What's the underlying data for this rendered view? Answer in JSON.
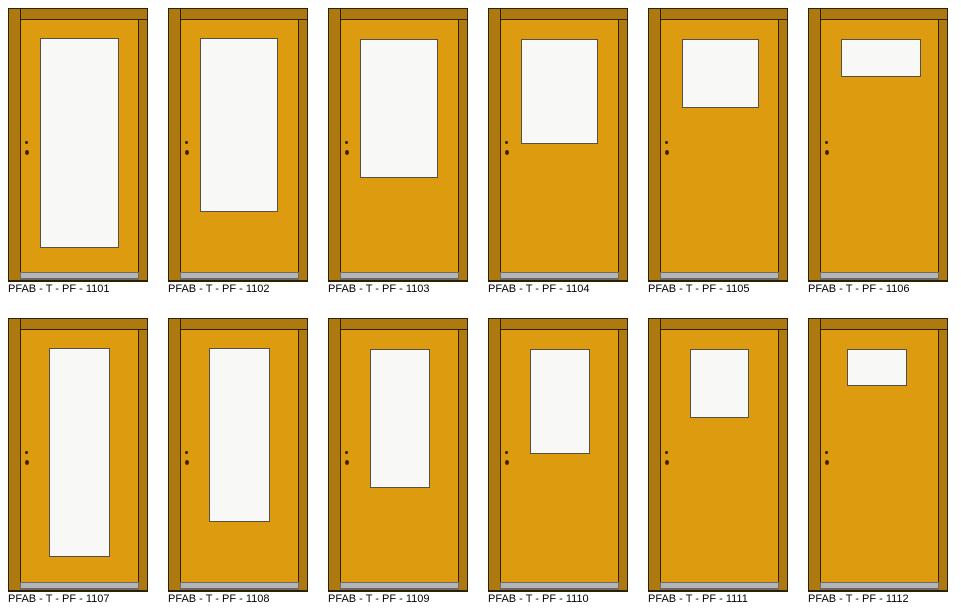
{
  "sheet": {
    "description": "Door type elevation sheet, 12 prefab door variants",
    "rows": 2,
    "cols": 6
  },
  "colors": {
    "page_bg": "#ffffff",
    "frame": "#ae7a10",
    "leaf": "#dd9b10",
    "outline": "#2e2100",
    "glass": "#f8f8f7",
    "glass_border": "#55514a",
    "threshold": "#b5b5b5",
    "hardware": "#3a2400",
    "hardware_lock": "#4a1f00",
    "label_text": "#000000"
  },
  "doors": [
    {
      "id": "1101",
      "label": "PFAB - T - PF - 1101",
      "row": 1,
      "glass": {
        "x": 32,
        "y": 30,
        "w": 79,
        "h": 210
      }
    },
    {
      "id": "1102",
      "label": "PFAB - T - PF - 1102",
      "row": 1,
      "glass": {
        "x": 32,
        "y": 30,
        "w": 78,
        "h": 174
      }
    },
    {
      "id": "1103",
      "label": "PFAB - T - PF - 1103",
      "row": 1,
      "glass": {
        "x": 32,
        "y": 31,
        "w": 78,
        "h": 139
      }
    },
    {
      "id": "1104",
      "label": "PFAB - T - PF - 1104",
      "row": 1,
      "glass": {
        "x": 33,
        "y": 31,
        "w": 77,
        "h": 105
      }
    },
    {
      "id": "1105",
      "label": "PFAB - T - PF - 1105",
      "row": 1,
      "glass": {
        "x": 34,
        "y": 31,
        "w": 77,
        "h": 69
      }
    },
    {
      "id": "1106",
      "label": "PFAB - T - PF - 1106",
      "row": 1,
      "glass": {
        "x": 33,
        "y": 31,
        "w": 80,
        "h": 38
      }
    },
    {
      "id": "1107",
      "label": "PFAB - T - PF - 1107",
      "row": 2,
      "glass": {
        "x": 41,
        "y": 30,
        "w": 61,
        "h": 209
      }
    },
    {
      "id": "1108",
      "label": "PFAB - T - PF - 1108",
      "row": 2,
      "glass": {
        "x": 41,
        "y": 30,
        "w": 61,
        "h": 174
      }
    },
    {
      "id": "1109",
      "label": "PFAB - T - PF - 1109",
      "row": 2,
      "glass": {
        "x": 42,
        "y": 31,
        "w": 60,
        "h": 139
      }
    },
    {
      "id": "1110",
      "label": "PFAB - T - PF - 1110",
      "row": 2,
      "glass": {
        "x": 42,
        "y": 31,
        "w": 60,
        "h": 105
      }
    },
    {
      "id": "1111",
      "label": "PFAB - T - PF - 1111",
      "row": 2,
      "glass": {
        "x": 42,
        "y": 31,
        "w": 59,
        "h": 69
      }
    },
    {
      "id": "1112",
      "label": "PFAB - T - PF - 1112",
      "row": 2,
      "glass": {
        "x": 39,
        "y": 31,
        "w": 60,
        "h": 37
      }
    }
  ]
}
